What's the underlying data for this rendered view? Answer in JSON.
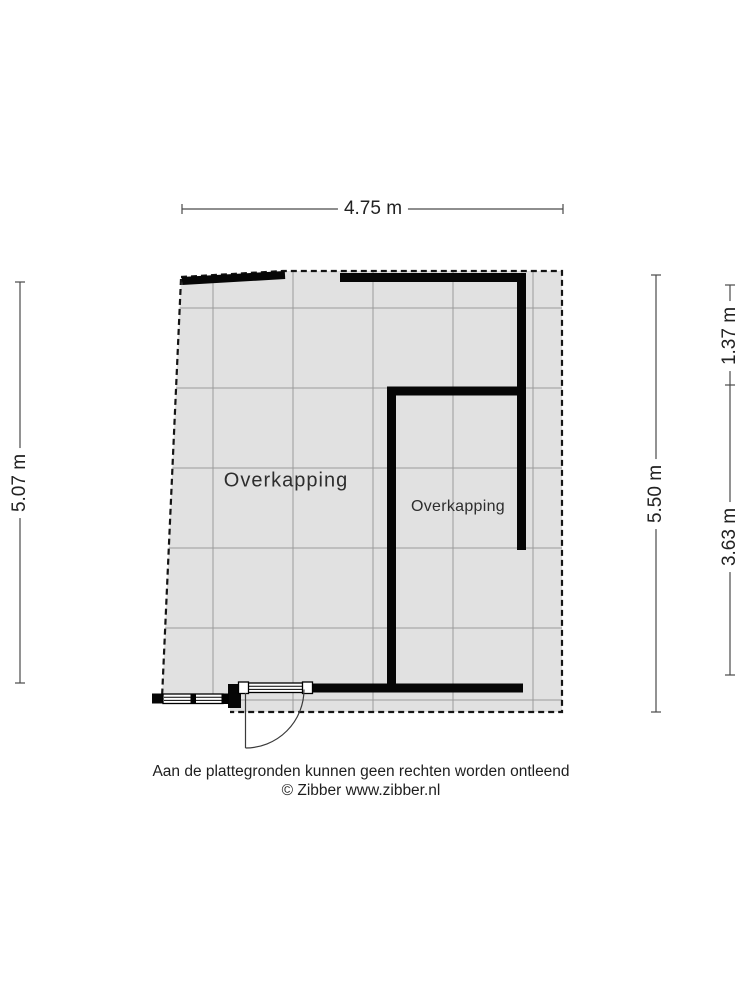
{
  "dimensions": {
    "top_width": "4.75 m",
    "left_height": "5.07 m",
    "right_total": "5.50 m",
    "right_upper": "1.37 m",
    "right_lower": "3.63 m"
  },
  "rooms": {
    "main_label": "Overkapping",
    "inner_label": "Overkapping"
  },
  "footer": {
    "disclaimer": "Aan de plattegronden kunnen geen rechten worden ontleend",
    "copyright": "© Zibber www.zibber.nl"
  },
  "colors": {
    "floor_fill": "#e1e1e1",
    "grid_line": "#9a9a9a",
    "wall": "#060606",
    "dimension_line": "#4a4a4a",
    "boundary": "#141414",
    "text": "#222222"
  }
}
